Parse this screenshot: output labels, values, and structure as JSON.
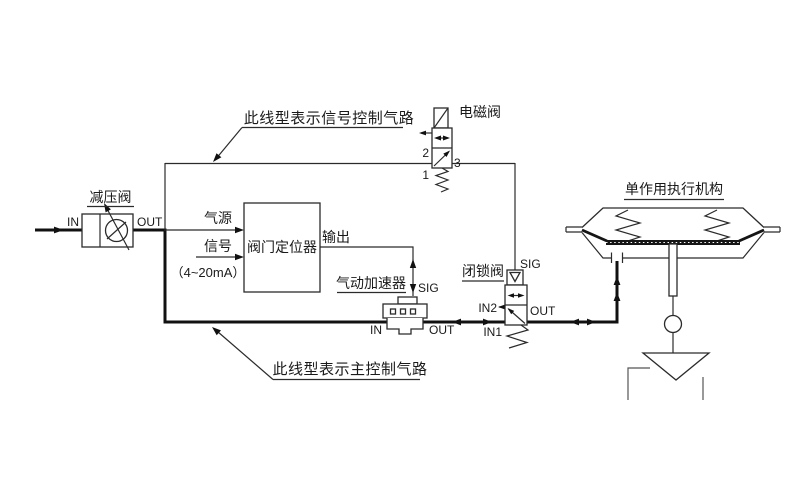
{
  "diagram": {
    "background": "#ffffff",
    "line_color": "#1a1a1a",
    "notes": {
      "signal_line": "此线型表示信号控制气路",
      "main_line": "此线型表示主控制气路"
    },
    "regulator": {
      "label": "减压阀",
      "port_in": "IN",
      "port_out": "OUT"
    },
    "positioner": {
      "label": "阀门定位器",
      "supply": "气源",
      "signal": "信号",
      "signal_range": "（4~20mA）",
      "output": "输出"
    },
    "solenoid_valve": {
      "label": "电磁阀",
      "port_1": "1",
      "port_2": "2",
      "port_3": "3"
    },
    "booster": {
      "label": "气动加速器",
      "port_sig": "SIG",
      "port_in": "IN",
      "port_out": "OUT"
    },
    "lockup_valve": {
      "label": "闭锁阀",
      "port_sig": "SIG",
      "port_in2": "IN2",
      "port_in1": "IN1",
      "port_out": "OUT"
    },
    "actuator": {
      "label": "单作用执行机构"
    }
  }
}
